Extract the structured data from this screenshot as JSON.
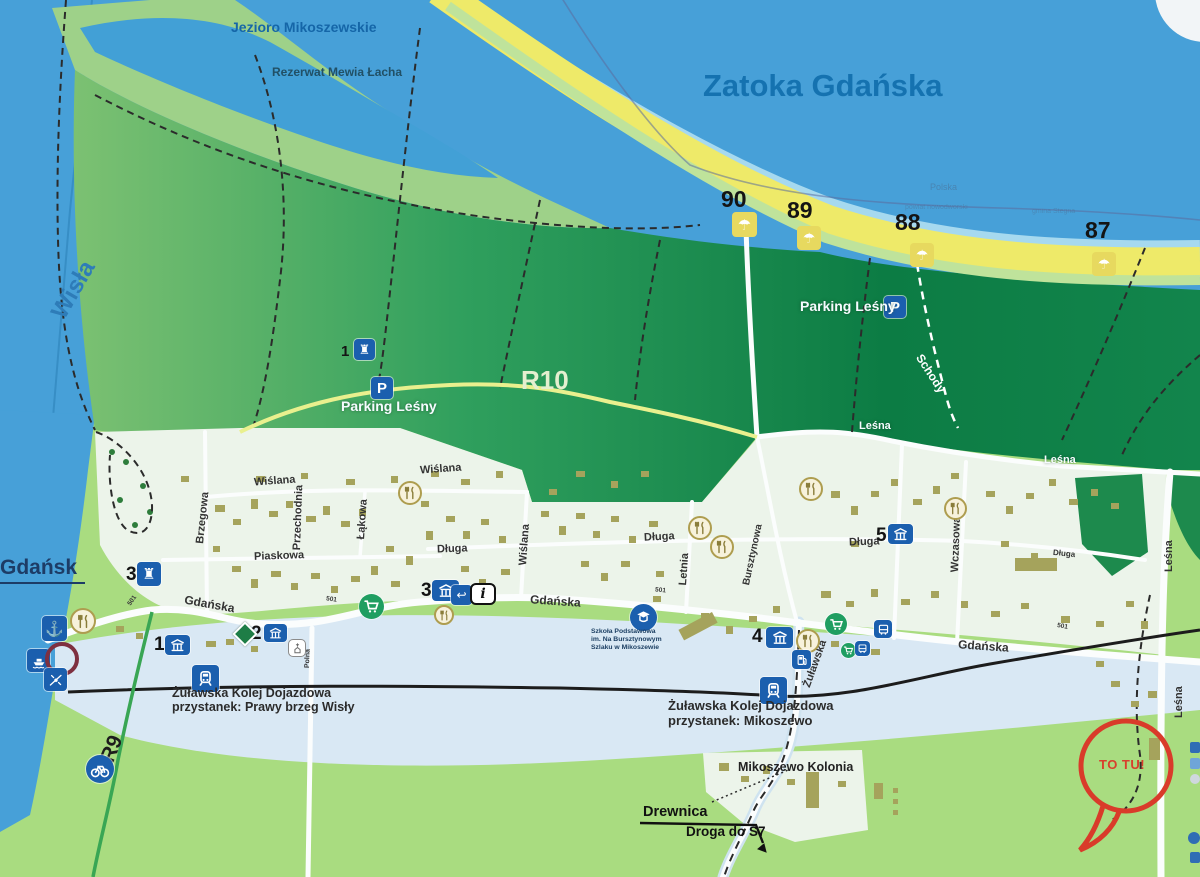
{
  "water": {
    "sea": "Zatoka Gdańska",
    "river": "Wisła",
    "lake": "Jezioro Mikoszewskie",
    "reserve": "Rezerwat Mewia Łacha"
  },
  "boundary": {
    "country": "Polska",
    "district": "powiat nowodworski",
    "commune": "gmina Stegna"
  },
  "beach": {
    "e90": "90",
    "e89": "89",
    "e88": "88",
    "e87": "87"
  },
  "routes": {
    "r10": "R10",
    "r9": "R9"
  },
  "parking": {
    "forest1": "Parking Leśny",
    "forest2": "Parking Leśny"
  },
  "streets": {
    "wislana_a": "Wiślana",
    "wislana_b": "Wiślana",
    "wislana_c": "Wiślana",
    "brzegowa": "Brzegowa",
    "przechodnia": "Przechodnia",
    "lakowa": "Łąkowa",
    "piaskowa": "Piaskowa",
    "dluga_a": "Długa",
    "dluga_b": "Długa",
    "dluga_c": "Długa",
    "dluga_d": "Długa",
    "gdanska_a": "Gdańska",
    "gdanska_b": "Gdańska",
    "gdanska_c": "Gdańska",
    "letnia": "Letnia",
    "bursztynowa": "Bursztynowa",
    "zulawska": "Żuławska",
    "wczasowa": "Wczasowa",
    "lesna_a": "Leśna",
    "lesna_b": "Leśna",
    "lesna_c": "Leśna",
    "lesna_d": "Leśna",
    "schody": "Schody",
    "polna": "Polna",
    "road_501": "501"
  },
  "pois": {
    "tower1": "1",
    "tower3": "3",
    "lodging1": "1",
    "lodging2": "2",
    "lodging3": "3",
    "lodging4": "4",
    "lodging5": "5",
    "school_line1": "Szkoła Podstawowa",
    "school_line2": "im. Na Bursztynowym",
    "school_line3": "Szlaku w Mikoszewie",
    "rail_a1": "Żuławska Kolej Dojazdowa",
    "rail_a2": "przystanek: Prawy brzeg Wisły",
    "rail_b1": "Żuławska Kolej Dojazdowa",
    "rail_b2": "przystanek: Mikoszewo"
  },
  "places": {
    "gdansk": "Gdańsk",
    "kolonia": "Mikoszewo Kolonia",
    "drewnica": "Drewnica",
    "droga_s7": "Droga do S7",
    "marker": "TO TU!"
  },
  "colors": {
    "sea": "#47a0d8",
    "beach": "#eeea69",
    "forest_dark": "#0c7c44",
    "village": "#ecf4ea",
    "accent_red": "#d93b2a",
    "icon_blue": "#1b5fae"
  }
}
